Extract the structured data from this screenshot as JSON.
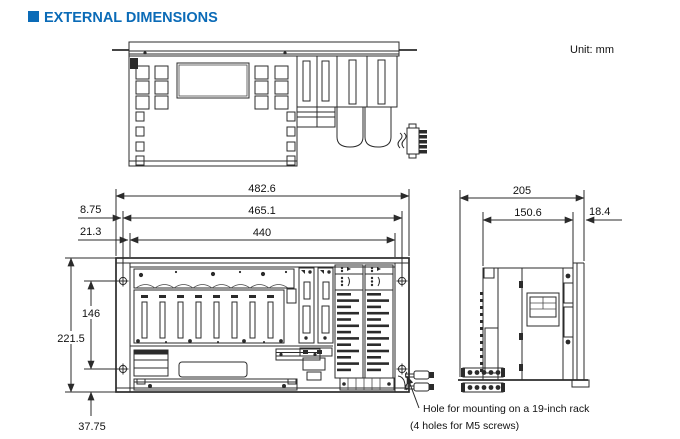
{
  "page": {
    "title": "EXTERNAL DIMENSIONS",
    "unit_label": "Unit:  mm"
  },
  "front_view_dimensions": {
    "width_overall": "482.6",
    "width_mounting_holes": "465.1",
    "width_body": "440",
    "offset_hole_side": "8.75",
    "offset_body_side": "21.3",
    "height_mounting_holes": "146",
    "height_overall": "221.5",
    "offset_hole_bottom": "37.75"
  },
  "side_view_dimensions": {
    "depth_overall": "205",
    "depth_body": "150.6",
    "flange_offset": "18.4"
  },
  "annotation": {
    "line1": "Hole for mounting on a 19-inch rack",
    "line2": "(4 holes for M5 screws)"
  },
  "colors": {
    "accent_blue": "#0b6bb7",
    "line_dark": "#2b2b2b"
  }
}
